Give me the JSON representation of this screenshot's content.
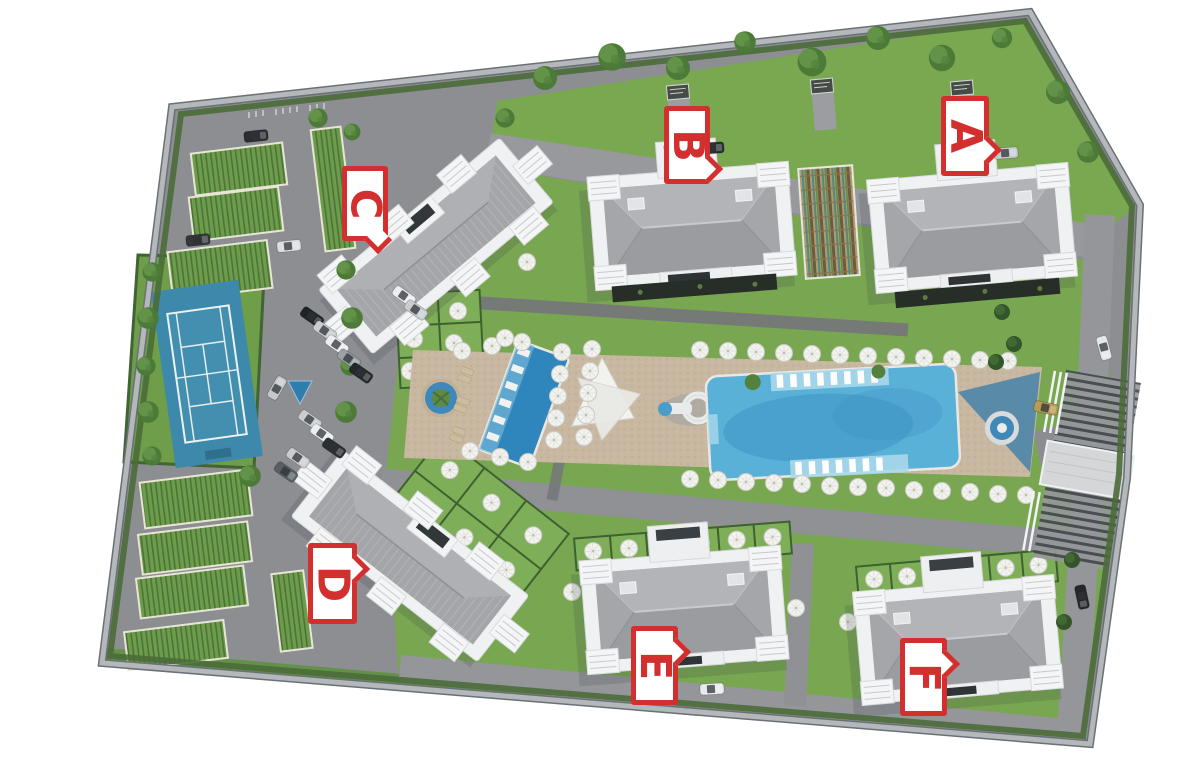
{
  "plan": {
    "markers": [
      {
        "id": "A",
        "label": "A"
      },
      {
        "id": "B",
        "label": "B"
      },
      {
        "id": "C",
        "label": "C"
      },
      {
        "id": "D",
        "label": "D"
      },
      {
        "id": "E",
        "label": "E"
      },
      {
        "id": "F",
        "label": "F"
      }
    ],
    "marker_color": "#d32f2f",
    "amenities": {
      "tennis_court": "tennis-court",
      "lap_pool": "lap-pool",
      "main_pool": "main-pool",
      "round_planter_pool": "round-planter-pool",
      "jacuzzi": "jacuzzi",
      "shade_sail": "shade-sail",
      "water_slide": "water-slide",
      "covered_parking": "covered-parking",
      "entrance_canopy": "entrance-canopy",
      "sun_umbrellas": "umbrella-icon",
      "sun_loungers": "lounger-icon"
    },
    "colors": {
      "grass": "#79a751",
      "asphalt": "#8c8e92",
      "deck": "#c9b8a1",
      "pool_water": "#5ab1d8",
      "court_blue": "#4090b1",
      "roof_gray": "#a6a8ab",
      "building_white": "#f1f2f3",
      "hedge_green": "#4a6b38"
    }
  }
}
